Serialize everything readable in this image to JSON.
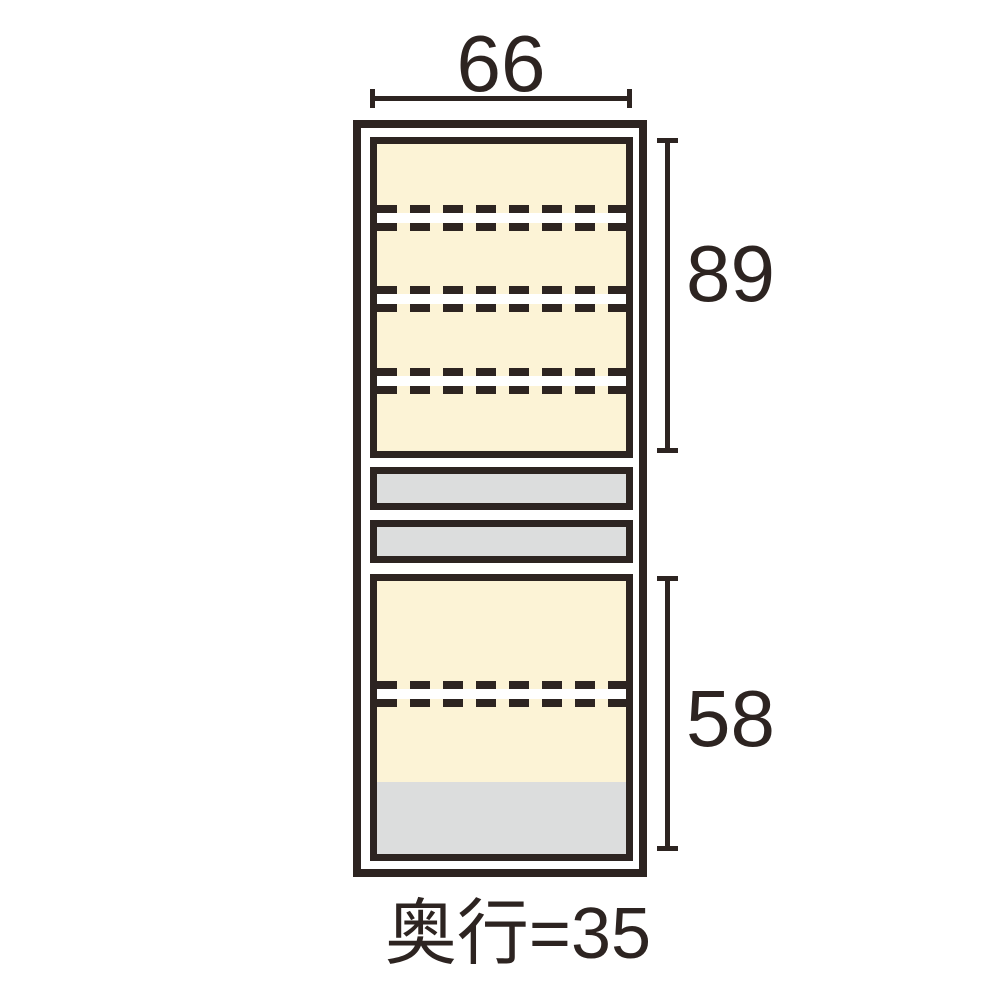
{
  "diagram": {
    "type": "furniture-front-dimension-diagram",
    "dimensions": {
      "width": "66",
      "upper_section_height": "89",
      "lower_section_height": "58",
      "depth_label": "奥行=35"
    },
    "structure": {
      "upper_adjustable_shelf_lines": 3,
      "drawers": 2,
      "lower_adjustable_shelf_lines": 1,
      "lower_base_panel": 1
    },
    "colors": {
      "outline": "#2d2421",
      "interior_fill": "#fcf3d6",
      "drawer_fill": "#dcdddd",
      "background": "#ffffff"
    }
  }
}
